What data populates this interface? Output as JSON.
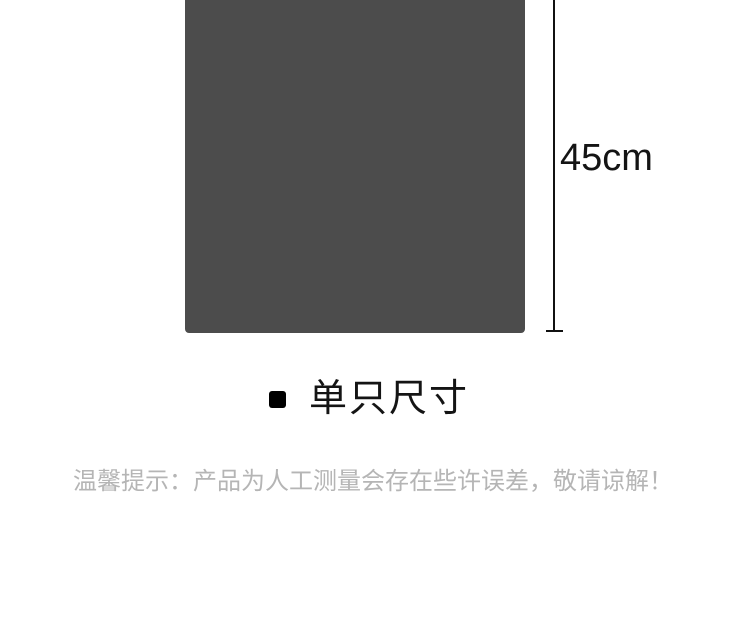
{
  "canvas": {
    "width": 750,
    "height": 625,
    "background": "#ffffff"
  },
  "size_diagram": {
    "product_swatch": {
      "description": "flat dark product area",
      "color": "#4c4c4c"
    },
    "dimension": {
      "label": "45cm",
      "line_color": "#111111",
      "label_color": "#141414"
    }
  },
  "section_heading": {
    "bullet_color": "#000000",
    "title": "单只尺寸",
    "title_color": "#141414"
  },
  "disclaimer": {
    "text": "温馨提示：产品为人工测量会存在些许误差，敬请谅解！",
    "color": "#b5b5b5"
  }
}
